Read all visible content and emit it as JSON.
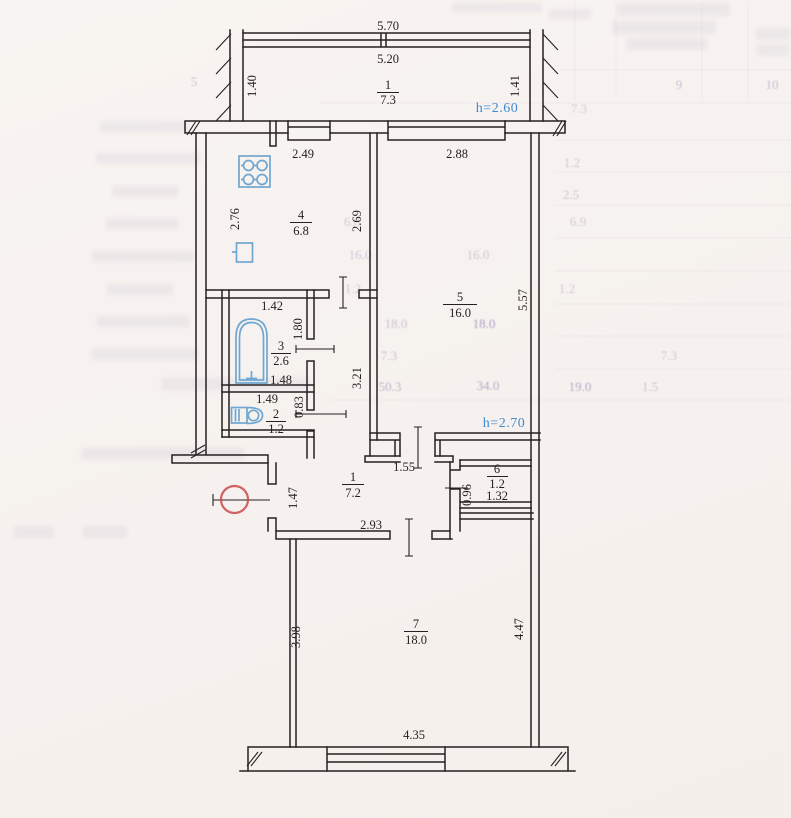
{
  "rooms": [
    {
      "name": "balcony",
      "num": "1",
      "area": "7.3"
    },
    {
      "name": "kitchen",
      "num": "4",
      "area": "6.8"
    },
    {
      "name": "bathroom",
      "num": "3",
      "area": "2.6"
    },
    {
      "name": "wc",
      "num": "2",
      "area": "1.2"
    },
    {
      "name": "living-room",
      "num": "5",
      "area": "16.0"
    },
    {
      "name": "hallway",
      "num": "1",
      "area": "7.2"
    },
    {
      "name": "closet",
      "num": "6",
      "area": "1.2"
    },
    {
      "name": "room",
      "num": "7",
      "area": "18.0"
    }
  ],
  "dimensions": {
    "balcony_outer": "5.70",
    "balcony_inner": "5.20",
    "balcony_left": "1.40",
    "balcony_right": "1.41",
    "kitchen_window": "2.49",
    "living_window": "2.88",
    "kitchen_left": "2.76",
    "kitchen_right": "2.69",
    "bath_top": "1.42",
    "bath_right": "1.80",
    "bath_bottom": "1.48",
    "wc_top": "1.49",
    "wc_right": "0.83",
    "corridor": "3.21",
    "living_right": "5.57",
    "hall_door": "1.55",
    "hall_entry": "1.47",
    "closet_width": "0.96",
    "closet_bottom": "1.32",
    "hall_bottom": "2.93",
    "room7_left": "3.98",
    "room7_right": "4.47",
    "room7_bottom": "4.35"
  },
  "heights": {
    "upper": "h=2.60",
    "lower": "h=2.70"
  },
  "colors": {
    "wall": "#262022",
    "fixture_blue": "#6fa7d2",
    "height_blue": "#3d8bd4",
    "stamp_red": "#cb4848",
    "paper": "#f7f2ef",
    "bleedthrough": "#9a8fb5"
  },
  "ghost_numbers": [
    "1.2",
    "2.5",
    "6.8",
    "6.9",
    "16.0",
    "16.0",
    "1.2",
    "1.2",
    "18.0",
    "18.0",
    "7.3",
    "7.3",
    "50.3",
    "34.0",
    "19.0",
    "1.5",
    "5",
    "9",
    "10",
    "7.3"
  ]
}
